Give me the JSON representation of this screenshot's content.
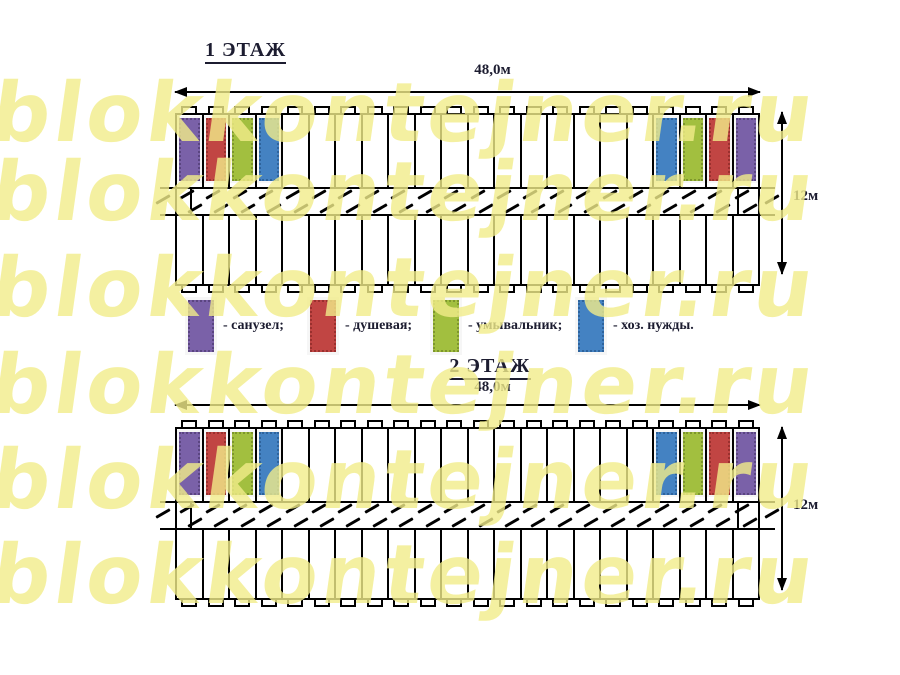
{
  "watermark": {
    "text": "blokkontejner.ru",
    "color": "#f2ed8a"
  },
  "floors": [
    {
      "label": "1 ЭТАЖ",
      "width_label": "48,0м",
      "height_label": "12м"
    },
    {
      "label": "2 ЭТАЖ",
      "width_label": "48,0м",
      "height_label": "12м"
    }
  ],
  "building": {
    "cells_per_row": 22,
    "left_colored": [
      "toilet",
      "shower",
      "washbasin",
      "utility"
    ],
    "right_colored": [
      "utility",
      "washbasin",
      "shower",
      "toilet"
    ]
  },
  "legend": [
    {
      "name": "toilet",
      "label": "- санузел;",
      "color": "#7a61a8",
      "border": "#5a4580"
    },
    {
      "name": "shower",
      "label": "- душевая;",
      "color": "#c14543",
      "border": "#99302e"
    },
    {
      "name": "washbasin",
      "label": "- умывальник;",
      "color": "#a2bf3f",
      "border": "#7d962c"
    },
    {
      "name": "utility",
      "label": "- хоз. нужды.",
      "color": "#4482c2",
      "border": "#2e639c"
    }
  ],
  "colors": {
    "line": "#000000",
    "text": "#1c1c30"
  }
}
